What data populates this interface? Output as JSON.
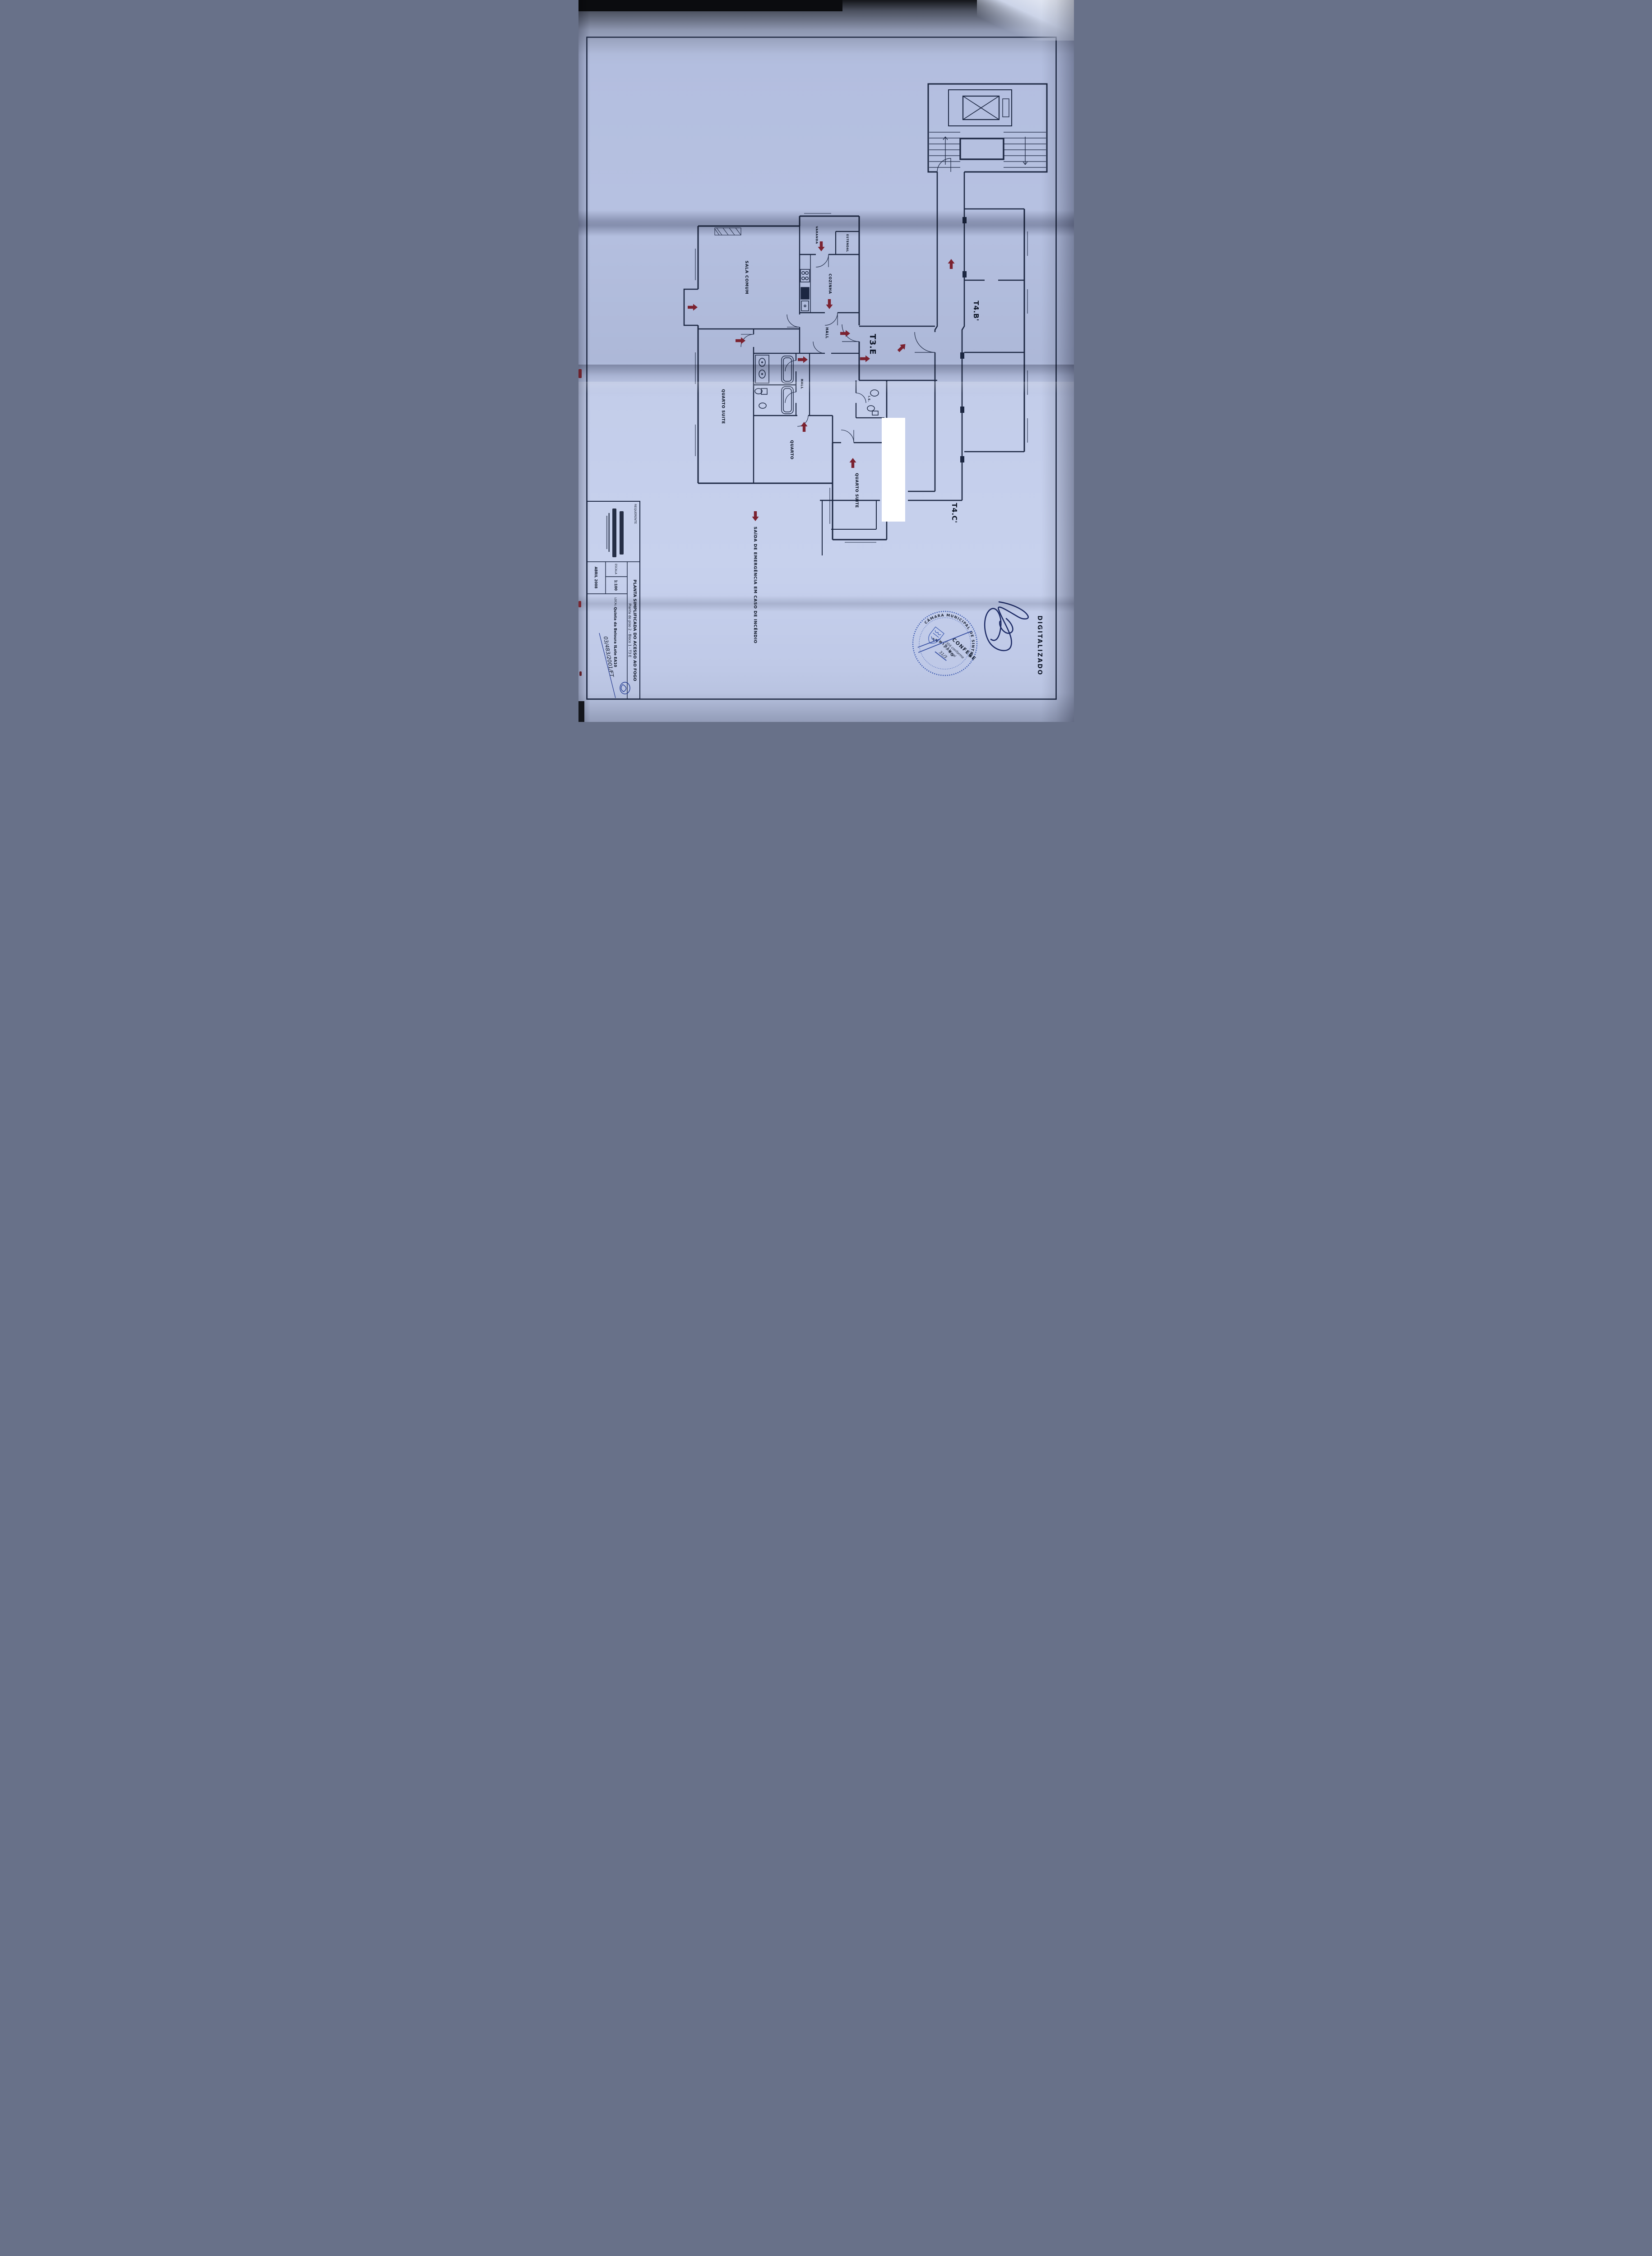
{
  "annotations": {
    "digitized": "DIGITALIZADO",
    "process_number": "03/483/2001/FT",
    "stamp_note_line1": "Está conforme",
    "stamp_note_line2": "o original",
    "stamp_date": "31/3"
  },
  "stamp": {
    "ring_top": "CÂMARA MUNICIPAL DE SINTRA",
    "ring_bottom": "ORIGINAL",
    "center": "CONFERE"
  },
  "title_block": {
    "requerente_label": "REQUERENTE",
    "title": "PLANTA SIMPLIFICADA DO ACESSO AO FOGO",
    "subtitle": "Planta do piso 2 - Bloco 1 - T3 E",
    "local_label": "LOCAL",
    "local_value": "Quinta da Beloura II",
    "lot": "Lote EA10",
    "scale_label": "ESCALA",
    "scale_value": "1:100",
    "date": "ABRIL 2008"
  },
  "plan": {
    "apartments": {
      "t3e": "T3.E",
      "t4b": "T4.B'",
      "t4c": "T4.C'"
    },
    "rooms": {
      "sala": "SALA COMUM",
      "cozinha": "COZINHA",
      "hall_entry": "HALL",
      "varanda": "VARANDA",
      "estendal": "ESTENDAL",
      "hall_bedrooms": "HALL",
      "quarto_suite_1": "QUARTO SUITE",
      "quarto": "QUARTO",
      "quarto_suite_2": "QUARTO SUITE",
      "wc": "I.S."
    },
    "exit_note": "SAÍDA DE EMERGÊNCIA EM CASO DE INCÊNDIO"
  },
  "colors": {
    "paper": "#b6c1e1",
    "ink": "#1c2742",
    "label_ink": "#0d1526",
    "escape_arrow": "#7b2230",
    "stamp_blue": "#3756ae",
    "signature_ink": "#1d2b66"
  }
}
